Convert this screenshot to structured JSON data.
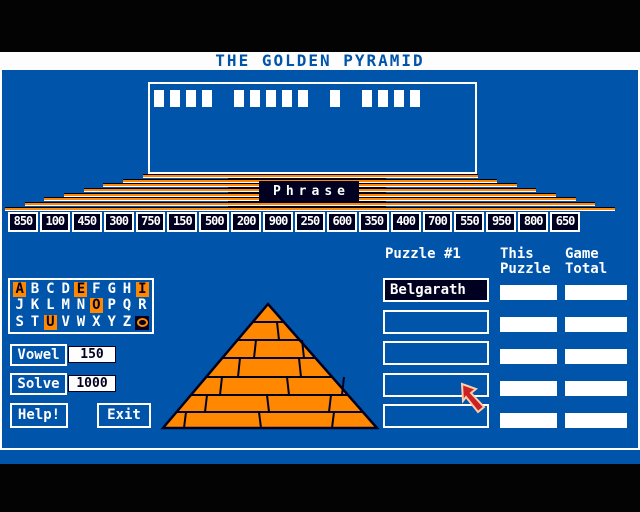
{
  "title": "THE GOLDEN PYRAMID",
  "colors": {
    "background_blue": "#0055aa",
    "orange": "#ff8800",
    "navy_black": "#000020",
    "white": "#ffffff",
    "pointer_red": "#cc2222",
    "title_text_blue": "#0055aa"
  },
  "phrase_board": {
    "label": "Phrase",
    "word_lengths": [
      4,
      5,
      1,
      4
    ]
  },
  "money_values": [
    "850",
    "100",
    "450",
    "300",
    "750",
    "150",
    "500",
    "200",
    "900",
    "250",
    "600",
    "350",
    "400",
    "700",
    "550",
    "950",
    "800",
    "650"
  ],
  "puzzle": {
    "header": "Puzzle #1",
    "names": [
      "Belgarath",
      "",
      "",
      "",
      ""
    ],
    "col_this": {
      "line1": "This",
      "line2": "Puzzle"
    },
    "col_total": {
      "line1": "Game",
      "line2": "Total"
    },
    "this_values": [
      "",
      "",
      "",
      "",
      ""
    ],
    "total_values": [
      "",
      "",
      "",
      "",
      ""
    ]
  },
  "alphabet": {
    "rows": [
      [
        "A",
        "B",
        "C",
        "D",
        "E",
        "F",
        "G",
        "H",
        "I"
      ],
      [
        "J",
        "K",
        "L",
        "M",
        "N",
        "O",
        "P",
        "Q",
        "R"
      ],
      [
        "S",
        "T",
        "U",
        "V",
        "W",
        "X",
        "Y",
        "Z",
        "©"
      ]
    ],
    "vowels": [
      "A",
      "E",
      "I",
      "O",
      "U"
    ],
    "symbol_name": "ring-icon"
  },
  "buttons": {
    "vowel": "Vowel",
    "solve": "Solve",
    "help": "Help!",
    "exit": "Exit"
  },
  "costs": {
    "vowel": "150",
    "solve": "1000"
  }
}
